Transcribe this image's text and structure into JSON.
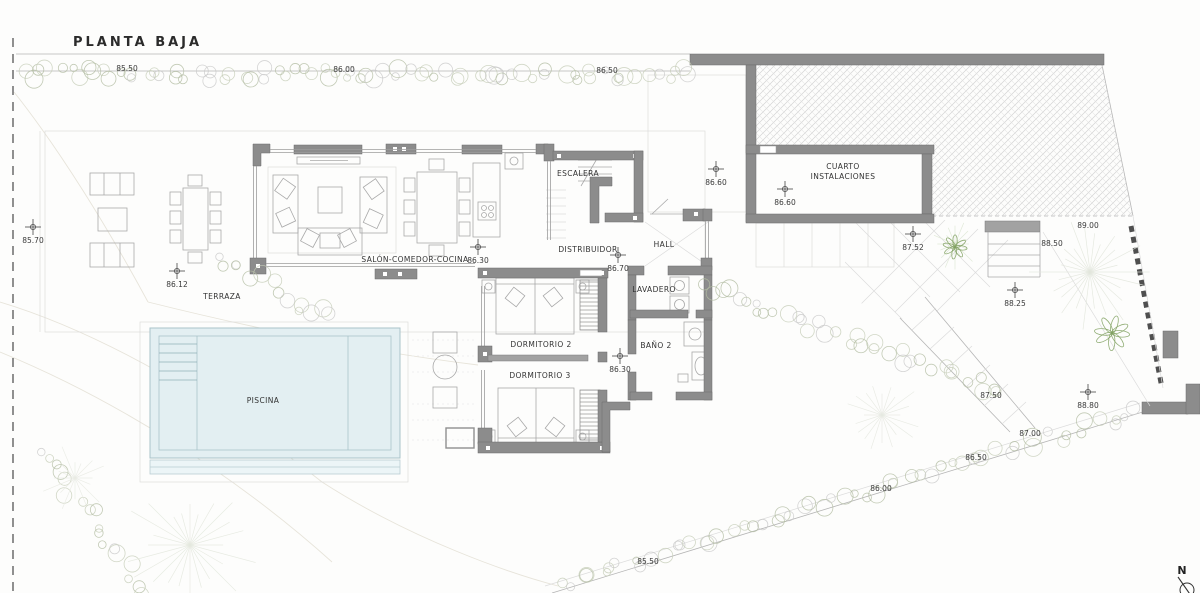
{
  "title": "PLANTA BAJA",
  "north_label": "N",
  "colors": {
    "wall_gray": "#8c8c8c",
    "pool_fill": "#e3eff2",
    "pool_line": "#a9c3c9",
    "vegetation_green": "#b3bda2",
    "plant_green": "#7fa05f",
    "hatch_line": "#d4d4d4",
    "text": "#333333"
  },
  "room_labels": [
    {
      "id": "escalera",
      "text": "ESCALERA",
      "x": 578,
      "y": 176
    },
    {
      "id": "cuarto-instalaciones",
      "lines": [
        "CUARTO",
        "INSTALACIONES"
      ],
      "x": 843,
      "y": 169
    },
    {
      "id": "distribuidor",
      "text": "DISTRIBUIDOR",
      "x": 588,
      "y": 252
    },
    {
      "id": "hall",
      "text": "HALL",
      "x": 664,
      "y": 247
    },
    {
      "id": "lavadero",
      "text": "LAVADERO",
      "x": 654,
      "y": 292
    },
    {
      "id": "bano-2",
      "text": "BAÑO 2",
      "x": 656,
      "y": 348
    },
    {
      "id": "dormitorio-2",
      "text": "DORMITORIO 2",
      "x": 541,
      "y": 347
    },
    {
      "id": "dormitorio-3",
      "text": "DORMITORIO 3",
      "x": 540,
      "y": 378
    },
    {
      "id": "salon-comedor-cocina",
      "text": "SALÓN-COMEDOR-COCINA",
      "x": 415,
      "y": 262
    },
    {
      "id": "terraza",
      "text": "TERRAZA",
      "x": 222,
      "y": 299
    },
    {
      "id": "piscina",
      "text": "PISCINA",
      "x": 263,
      "y": 403
    }
  ],
  "spot_elevations": [
    {
      "value": "86.60",
      "x": 716,
      "y": 169
    },
    {
      "value": "86.60",
      "x": 785,
      "y": 189
    },
    {
      "value": "85.70",
      "x": 33,
      "y": 227
    },
    {
      "value": "86.12",
      "x": 177,
      "y": 271
    },
    {
      "value": "86.30",
      "x": 478,
      "y": 247
    },
    {
      "value": "86.70",
      "x": 618,
      "y": 255
    },
    {
      "value": "86.30",
      "x": 620,
      "y": 356
    },
    {
      "value": "87.52",
      "x": 913,
      "y": 234
    },
    {
      "value": "88.25",
      "x": 1015,
      "y": 290
    },
    {
      "value": "88.80",
      "x": 1088,
      "y": 392
    }
  ],
  "level_labels": [
    {
      "value": "85.50",
      "x": 127,
      "y": 71
    },
    {
      "value": "86.00",
      "x": 344,
      "y": 72
    },
    {
      "value": "86.50",
      "x": 607,
      "y": 73
    },
    {
      "value": "89.00",
      "x": 1088,
      "y": 228
    },
    {
      "value": "88.50",
      "x": 1052,
      "y": 246
    },
    {
      "value": "87.50",
      "x": 991,
      "y": 398
    },
    {
      "value": "87.00",
      "x": 1030,
      "y": 436
    },
    {
      "value": "86.50",
      "x": 976,
      "y": 460
    },
    {
      "value": "86.00",
      "x": 881,
      "y": 491
    },
    {
      "value": "85.50",
      "x": 648,
      "y": 564
    }
  ]
}
